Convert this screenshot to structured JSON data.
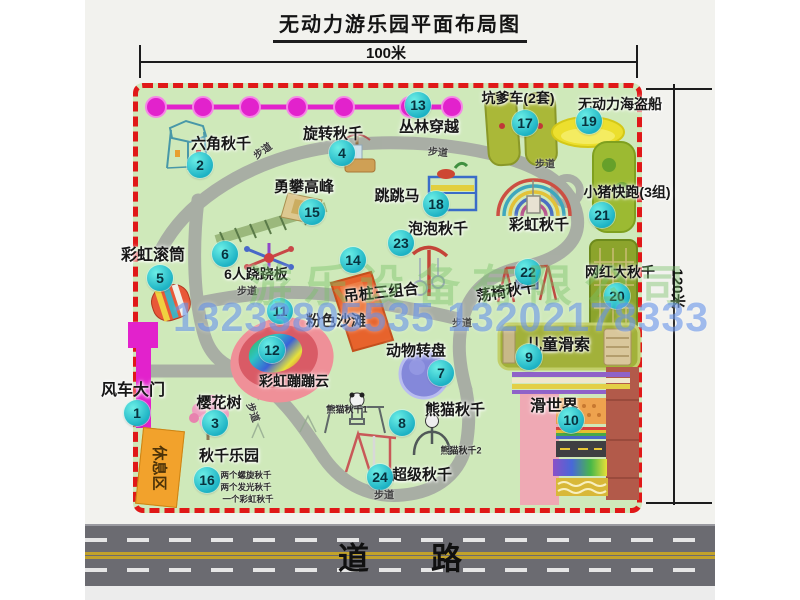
{
  "title": "无动力游乐园平面布局图",
  "dimensions": {
    "width_label": "100米",
    "height_label": "120米"
  },
  "watermark": {
    "company": "游乐设备有限公司",
    "phone": "13233805535 13202178333"
  },
  "road": {
    "label": "道　　路"
  },
  "path_label": "步道",
  "rest_area": {
    "label": "休息区"
  },
  "colors": {
    "map_green": "#cfe9ba",
    "border_red": "#e01818",
    "badge_cyan": "#1cb2c4",
    "gate_magenta": "#e222cc",
    "chain_magenta": "#e222cc",
    "rest_orange": "#f2a22c",
    "road_gray": "#6b6b71",
    "pirate_yellow": "#ecdf2e"
  },
  "items": [
    {
      "num": "1",
      "label": "风车大门",
      "lx": 133,
      "ly": 388,
      "bx": 137,
      "by": 413,
      "fs": 16
    },
    {
      "num": "2",
      "label": "六角秋千",
      "lx": 221,
      "ly": 143,
      "bx": 200,
      "by": 165,
      "fs": 15
    },
    {
      "num": "3",
      "label": "樱花树",
      "lx": 219,
      "ly": 402,
      "bx": 215,
      "by": 423,
      "fs": 15
    },
    {
      "num": "4",
      "label": "旋转秋千",
      "lx": 333,
      "ly": 133,
      "bx": 342,
      "by": 153,
      "fs": 15
    },
    {
      "num": "5",
      "label": "彩虹滚筒",
      "lx": 153,
      "ly": 253,
      "bx": 160,
      "by": 278,
      "fs": 16
    },
    {
      "num": "6",
      "label": "6人跷跷板",
      "lx": 256,
      "ly": 274,
      "bx": 225,
      "by": 254,
      "fs": 14
    },
    {
      "num": "7",
      "label": "动物转盘",
      "lx": 416,
      "ly": 350,
      "bx": 441,
      "by": 373,
      "fs": 15
    },
    {
      "num": "8",
      "label": "熊猫秋千",
      "lx": 455,
      "ly": 409,
      "bx": 402,
      "by": 423,
      "fs": 15
    },
    {
      "num": "9",
      "label": "儿童滑索",
      "lx": 558,
      "ly": 343,
      "bx": 529,
      "by": 357,
      "fs": 16
    },
    {
      "num": "10",
      "label": "滑世界",
      "lx": 554,
      "ly": 404,
      "bx": 571,
      "by": 420,
      "fs": 16
    },
    {
      "num": "11",
      "label": "粉色沙滩",
      "lx": 336,
      "ly": 320,
      "bx": 280,
      "by": 311,
      "fs": 15
    },
    {
      "num": "12",
      "label": "彩虹蹦蹦云",
      "lx": 294,
      "ly": 381,
      "bx": 272,
      "by": 350,
      "fs": 14
    },
    {
      "num": "13",
      "label": "丛林穿越",
      "lx": 429,
      "ly": 126,
      "bx": 418,
      "by": 105,
      "fs": 15
    },
    {
      "num": "14",
      "label": "吊桩三组合",
      "lx": 381,
      "ly": 292,
      "bx": 353,
      "by": 260,
      "fs": 15,
      "rot": -6
    },
    {
      "num": "15",
      "label": "勇攀高峰",
      "lx": 304,
      "ly": 186,
      "bx": 312,
      "by": 212,
      "fs": 15
    },
    {
      "num": "16",
      "label": "秋千乐园",
      "lx": 229,
      "ly": 455,
      "bx": 207,
      "by": 480,
      "fs": 15
    },
    {
      "num": "17",
      "label": "坑爹车(2套)",
      "lx": 518,
      "ly": 98,
      "bx": 525,
      "by": 123,
      "fs": 14
    },
    {
      "num": "18",
      "label": "跳跳马",
      "lx": 397,
      "ly": 195,
      "bx": 436,
      "by": 204,
      "fs": 15
    },
    {
      "num": "19",
      "label": "无动力海盗船",
      "lx": 620,
      "ly": 104,
      "bx": 589,
      "by": 121,
      "fs": 14
    },
    {
      "num": "20",
      "label": "网红大秋千",
      "lx": 620,
      "ly": 272,
      "bx": 617,
      "by": 296,
      "fs": 14
    },
    {
      "num": "21",
      "label": "小猪快跑(3组)",
      "lx": 627,
      "ly": 192,
      "bx": 602,
      "by": 215,
      "fs": 14
    },
    {
      "num": "22",
      "label": "荡椅秋千",
      "lx": 506,
      "ly": 291,
      "bx": 528,
      "by": 272,
      "fs": 15,
      "rot": -10
    },
    {
      "num": "23",
      "label": "泡泡秋千",
      "lx": 438,
      "ly": 228,
      "bx": 401,
      "by": 243,
      "fs": 15
    },
    {
      "num": "24",
      "label": "超级秋千",
      "lx": 422,
      "ly": 474,
      "bx": 380,
      "by": 477,
      "fs": 15
    },
    {
      "num": null,
      "label": "彩虹秋千",
      "lx": 539,
      "ly": 224,
      "fs": 15
    }
  ],
  "sub_labels": [
    {
      "text": "熊猫秋千1",
      "x": 347,
      "y": 409,
      "fs": 9
    },
    {
      "text": "熊猫秋千2",
      "x": 461,
      "y": 450,
      "fs": 9
    },
    {
      "text": "两个螺旋秋千",
      "x": 246,
      "y": 475,
      "fs": 8.5
    },
    {
      "text": "两个发光秋千",
      "x": 246,
      "y": 487,
      "fs": 8.5
    },
    {
      "text": "一个彩虹秋千",
      "x": 248,
      "y": 499,
      "fs": 8.5
    }
  ],
  "path_labels": [
    {
      "x": 262,
      "y": 150,
      "r": -35
    },
    {
      "x": 438,
      "y": 151,
      "r": 5
    },
    {
      "x": 545,
      "y": 163,
      "r": 0
    },
    {
      "x": 247,
      "y": 290,
      "r": 0
    },
    {
      "x": 254,
      "y": 412,
      "r": 70
    },
    {
      "x": 384,
      "y": 494,
      "r": 0
    },
    {
      "x": 462,
      "y": 322,
      "r": 0
    }
  ]
}
